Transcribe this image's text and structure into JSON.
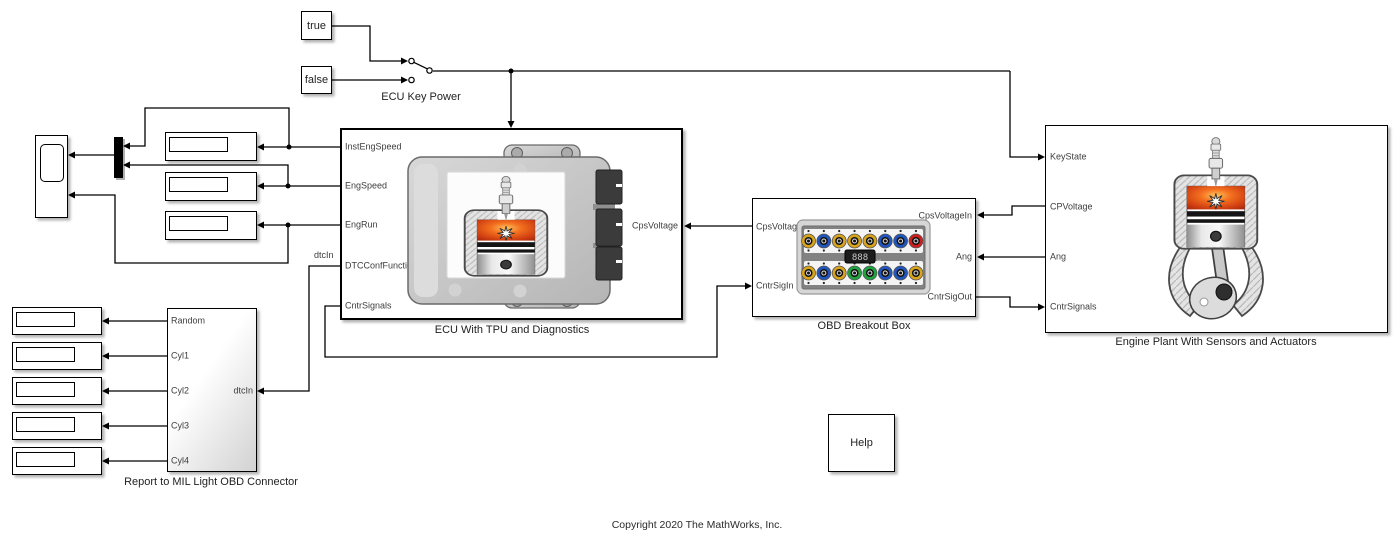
{
  "copyright": "Copyright 2020 The MathWorks, Inc.",
  "constants": {
    "true_label": "true",
    "false_label": "false"
  },
  "switch": {
    "label": "ECU Key Power"
  },
  "ecu": {
    "name": "ECU With TPU and Diagnostics",
    "left_ports": [
      "InstEngSpeed",
      "EngSpeed",
      "EngRun",
      "DTCConfFunctionTPU",
      "CntrSignals"
    ],
    "right_ports": [
      "CpsVoltage"
    ]
  },
  "obd": {
    "name": "OBD Breakout Box",
    "left_ports": [
      "CpsVoltageOut",
      "CntrSigIn"
    ],
    "right_ports": [
      "CpsVoltageIn",
      "Ang",
      "CntrSigOut"
    ],
    "meter": {
      "value": "888",
      "unit": "v"
    },
    "jack_rows": [
      [
        "#d9a31b",
        "#2155bd",
        "#d9a31b",
        "#d9a31b",
        "#d9a31b",
        "#2155bd",
        "#2155bd",
        "#cf1d1d"
      ],
      [
        "#d9a31b",
        "#2155bd",
        "#d9a31b",
        "#1ea43c",
        "#1ea43c",
        "#2155bd",
        "#2155bd",
        "#d9a31b"
      ]
    ]
  },
  "engine": {
    "name": "Engine Plant With Sensors and Actuators",
    "left_ports": [
      "KeyState",
      "CPVoltage",
      "Ang",
      "CntrSignals"
    ]
  },
  "report": {
    "name": "Report to MIL Light OBD Connector",
    "left_ports": [
      "Random",
      "Cyl1",
      "Cyl2",
      "Cyl3",
      "Cyl4"
    ],
    "right_ports": [
      "dtcIn"
    ]
  },
  "help": {
    "label": "Help"
  },
  "signal_labels": {
    "dtc": "dtcIn"
  },
  "colors": {
    "wire": "#000000",
    "block_border": "#000000",
    "port_text": "#3d3d3d"
  }
}
